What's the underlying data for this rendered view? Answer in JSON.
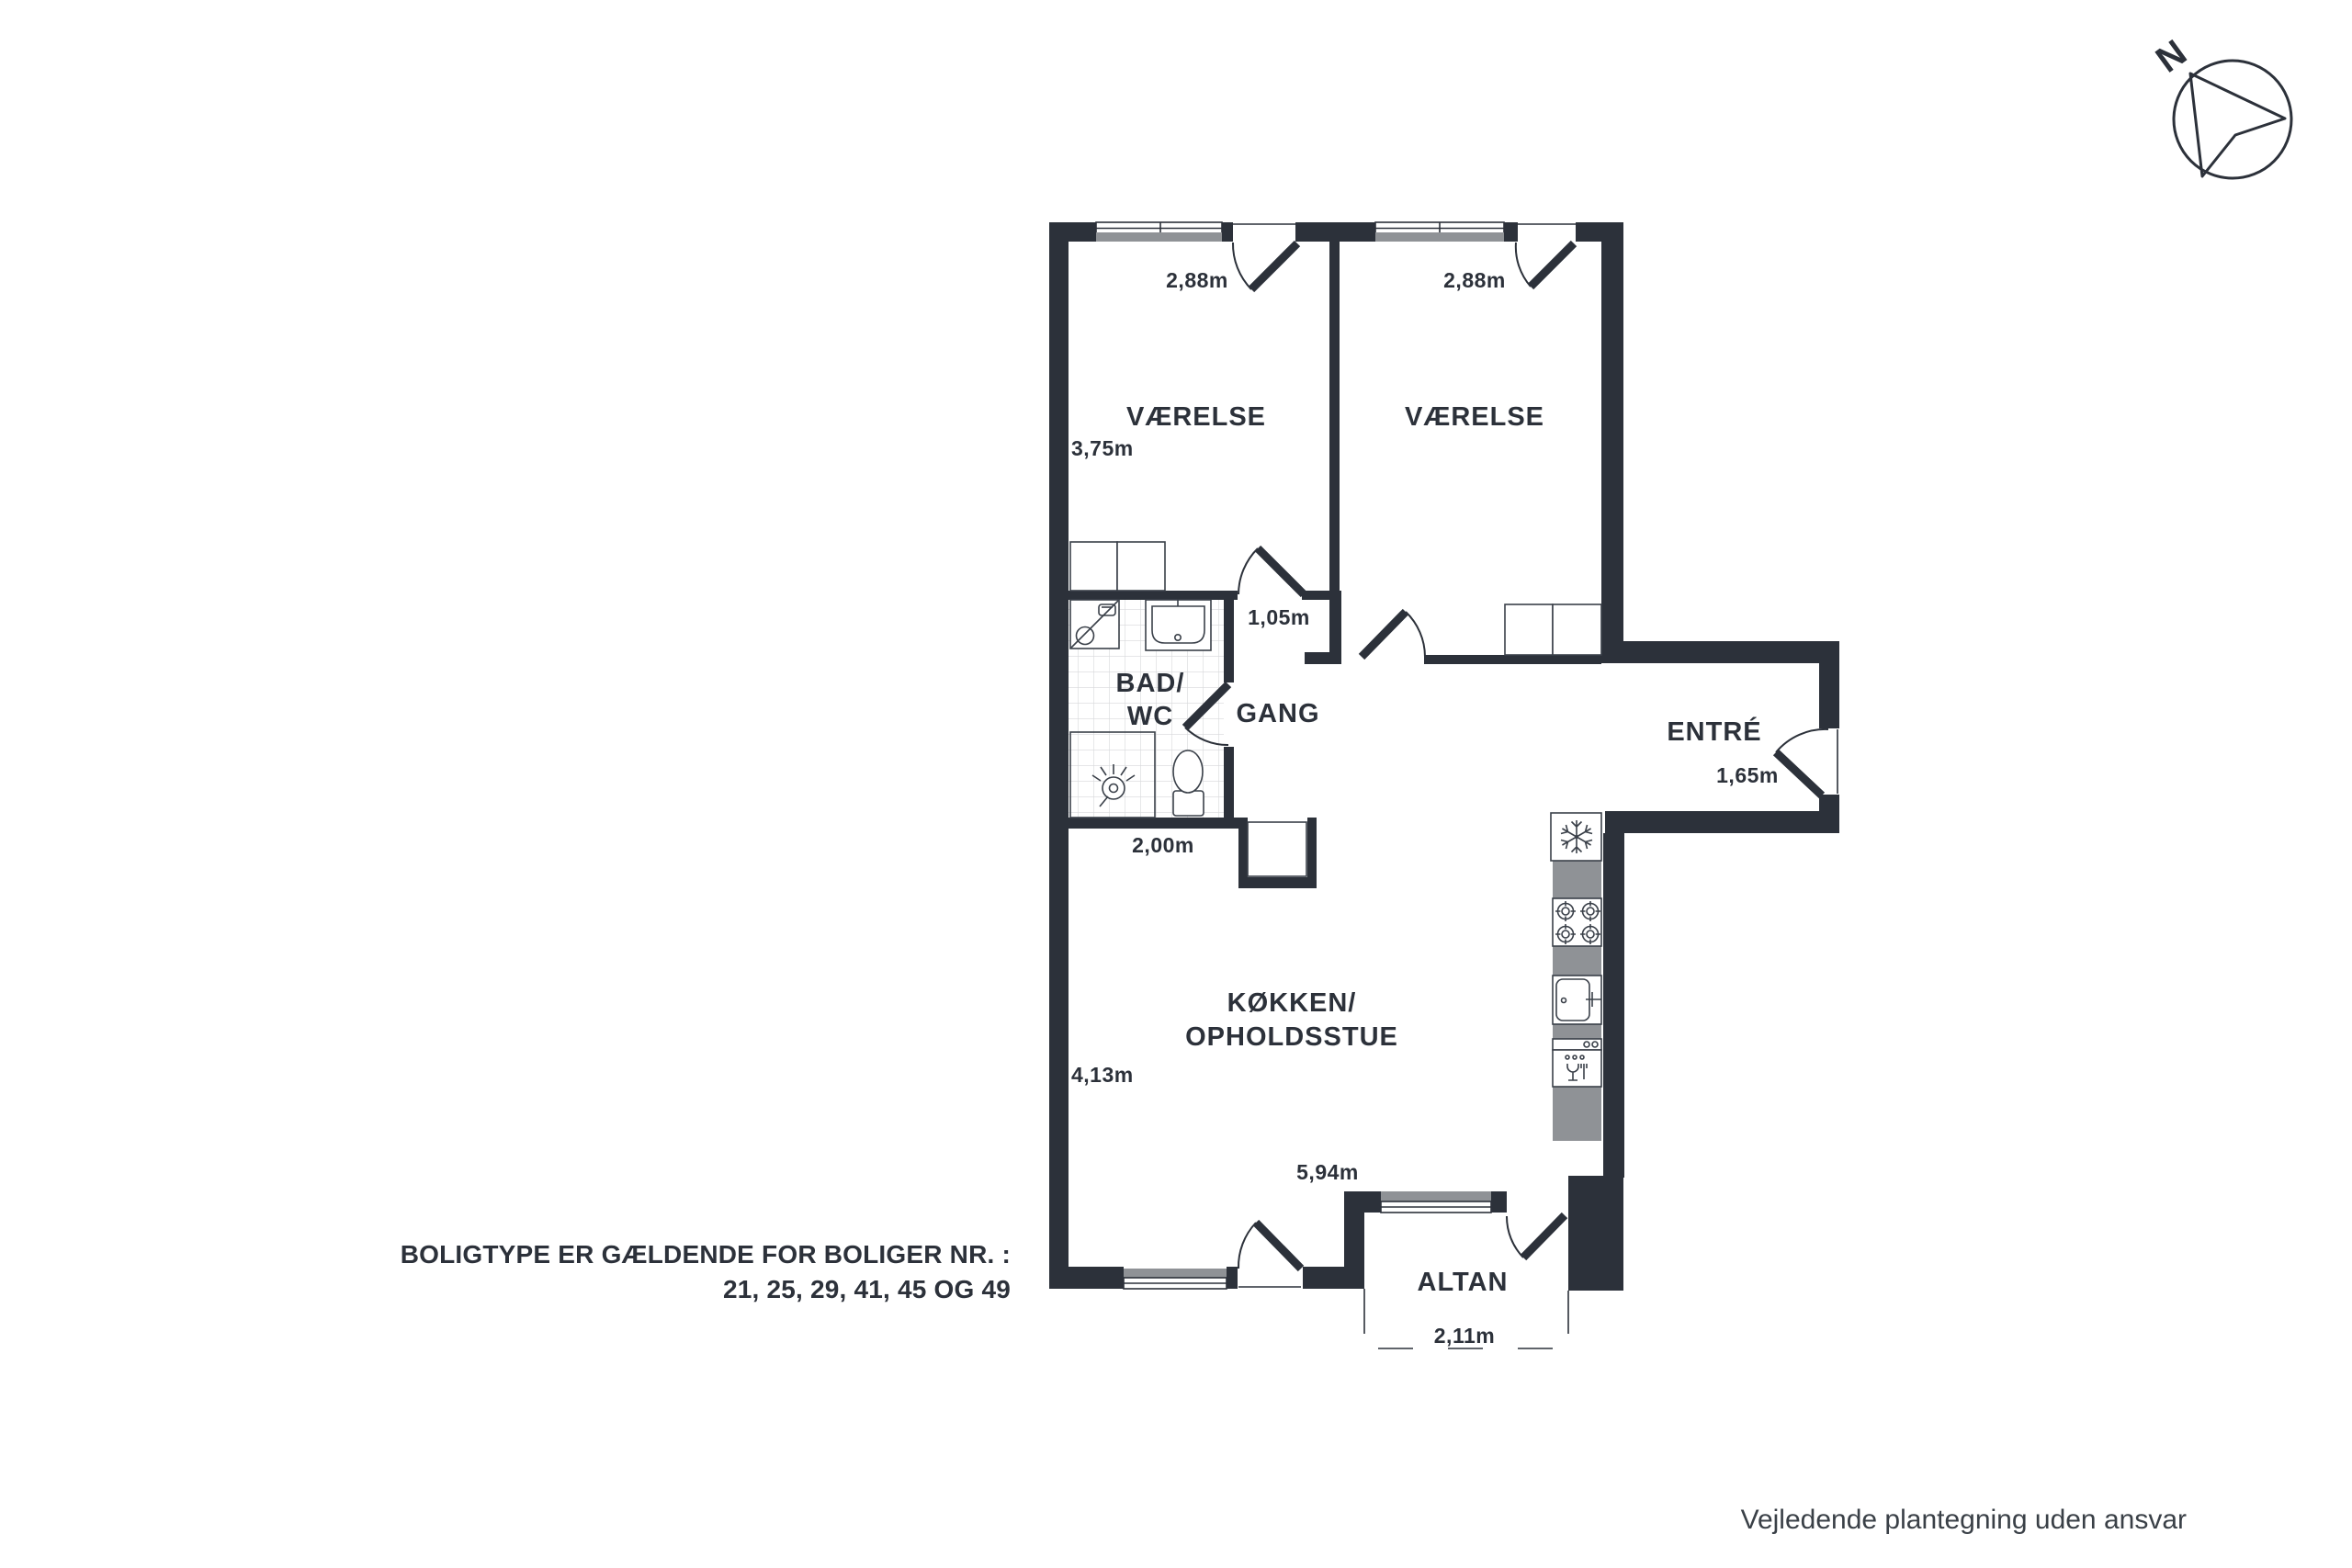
{
  "colors": {
    "wall": "#2c313a",
    "window_gray": "#8f9296",
    "tile_line": "#d7d8da",
    "fixture_line": "#3a4049",
    "text": "#2c313a"
  },
  "compass": {
    "label": "N"
  },
  "rooms": {
    "bedroom_left": {
      "name": "VÆRELSE",
      "width_label": "2,88m",
      "depth_label": "3,75m"
    },
    "bedroom_right": {
      "name": "VÆRELSE",
      "width_label": "2,88m"
    },
    "bath": {
      "name_line1": "BAD/",
      "name_line2": "WC",
      "width_label": "2,00m"
    },
    "hall": {
      "name": "GANG",
      "width_label": "1,05m"
    },
    "entry": {
      "name": "ENTRÉ",
      "width_label": "1,65m"
    },
    "kitchen": {
      "name_line1": "KØKKEN/",
      "name_line2": "OPHOLDSSTUE",
      "depth_label": "4,13m",
      "width_label": "5,94m"
    },
    "balcony": {
      "name": "ALTAN",
      "width_label": "2,11m"
    }
  },
  "notes": {
    "housing_type_line1": "BOLIGTYPE ER GÆLDENDE FOR BOLIGER NR. :",
    "housing_type_line2": "21, 25, 29, 41, 45 OG 49",
    "disclaimer": "Vejledende plantegning uden ansvar"
  }
}
